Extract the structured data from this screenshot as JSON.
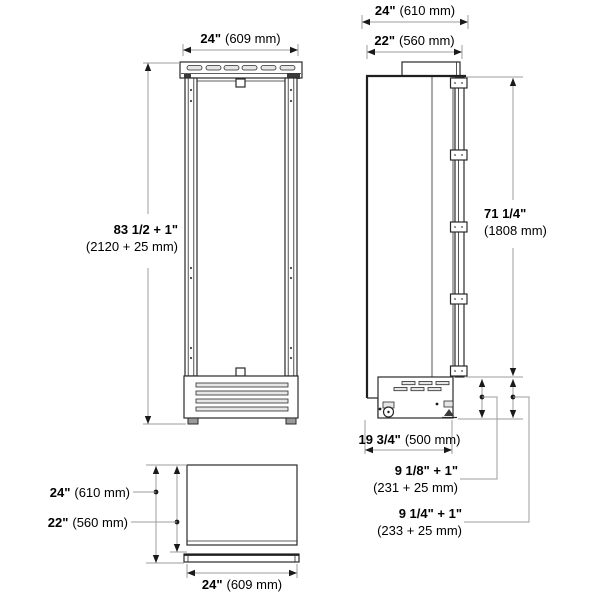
{
  "front_view": {
    "width": {
      "in": "24\"",
      "mm": "(609 mm)"
    },
    "height": {
      "in": "83 1/2 + 1\"",
      "mm": "(2120 + 25 mm)"
    }
  },
  "side_view": {
    "depth_overall": {
      "in": "24\"",
      "mm": "(610 mm)"
    },
    "depth_case": {
      "in": "22\"",
      "mm": "(560 mm)"
    },
    "door_height": {
      "in": "71 1/4\"",
      "mm": "(1808 mm)"
    },
    "base_depth": {
      "in": "19 3/4\"",
      "mm": "(500 mm)"
    },
    "rear_clearance_upper": {
      "in": "9 1/8\" + 1\"",
      "mm": "(231 + 25 mm)"
    },
    "rear_clearance_lower": {
      "in": "9 1/4\" + 1\"",
      "mm": "(233 + 25 mm)"
    }
  },
  "top_view": {
    "depth_overall": {
      "in": "24\"",
      "mm": "(610 mm)"
    },
    "depth_case": {
      "in": "22\"",
      "mm": "(560 mm)"
    },
    "width": {
      "in": "24\"",
      "mm": "(609 mm)"
    }
  },
  "colors": {
    "object_line": "#2a2a2a",
    "dimension_line": "#9c9c9c",
    "text": "#000000",
    "background": "#ffffff"
  }
}
